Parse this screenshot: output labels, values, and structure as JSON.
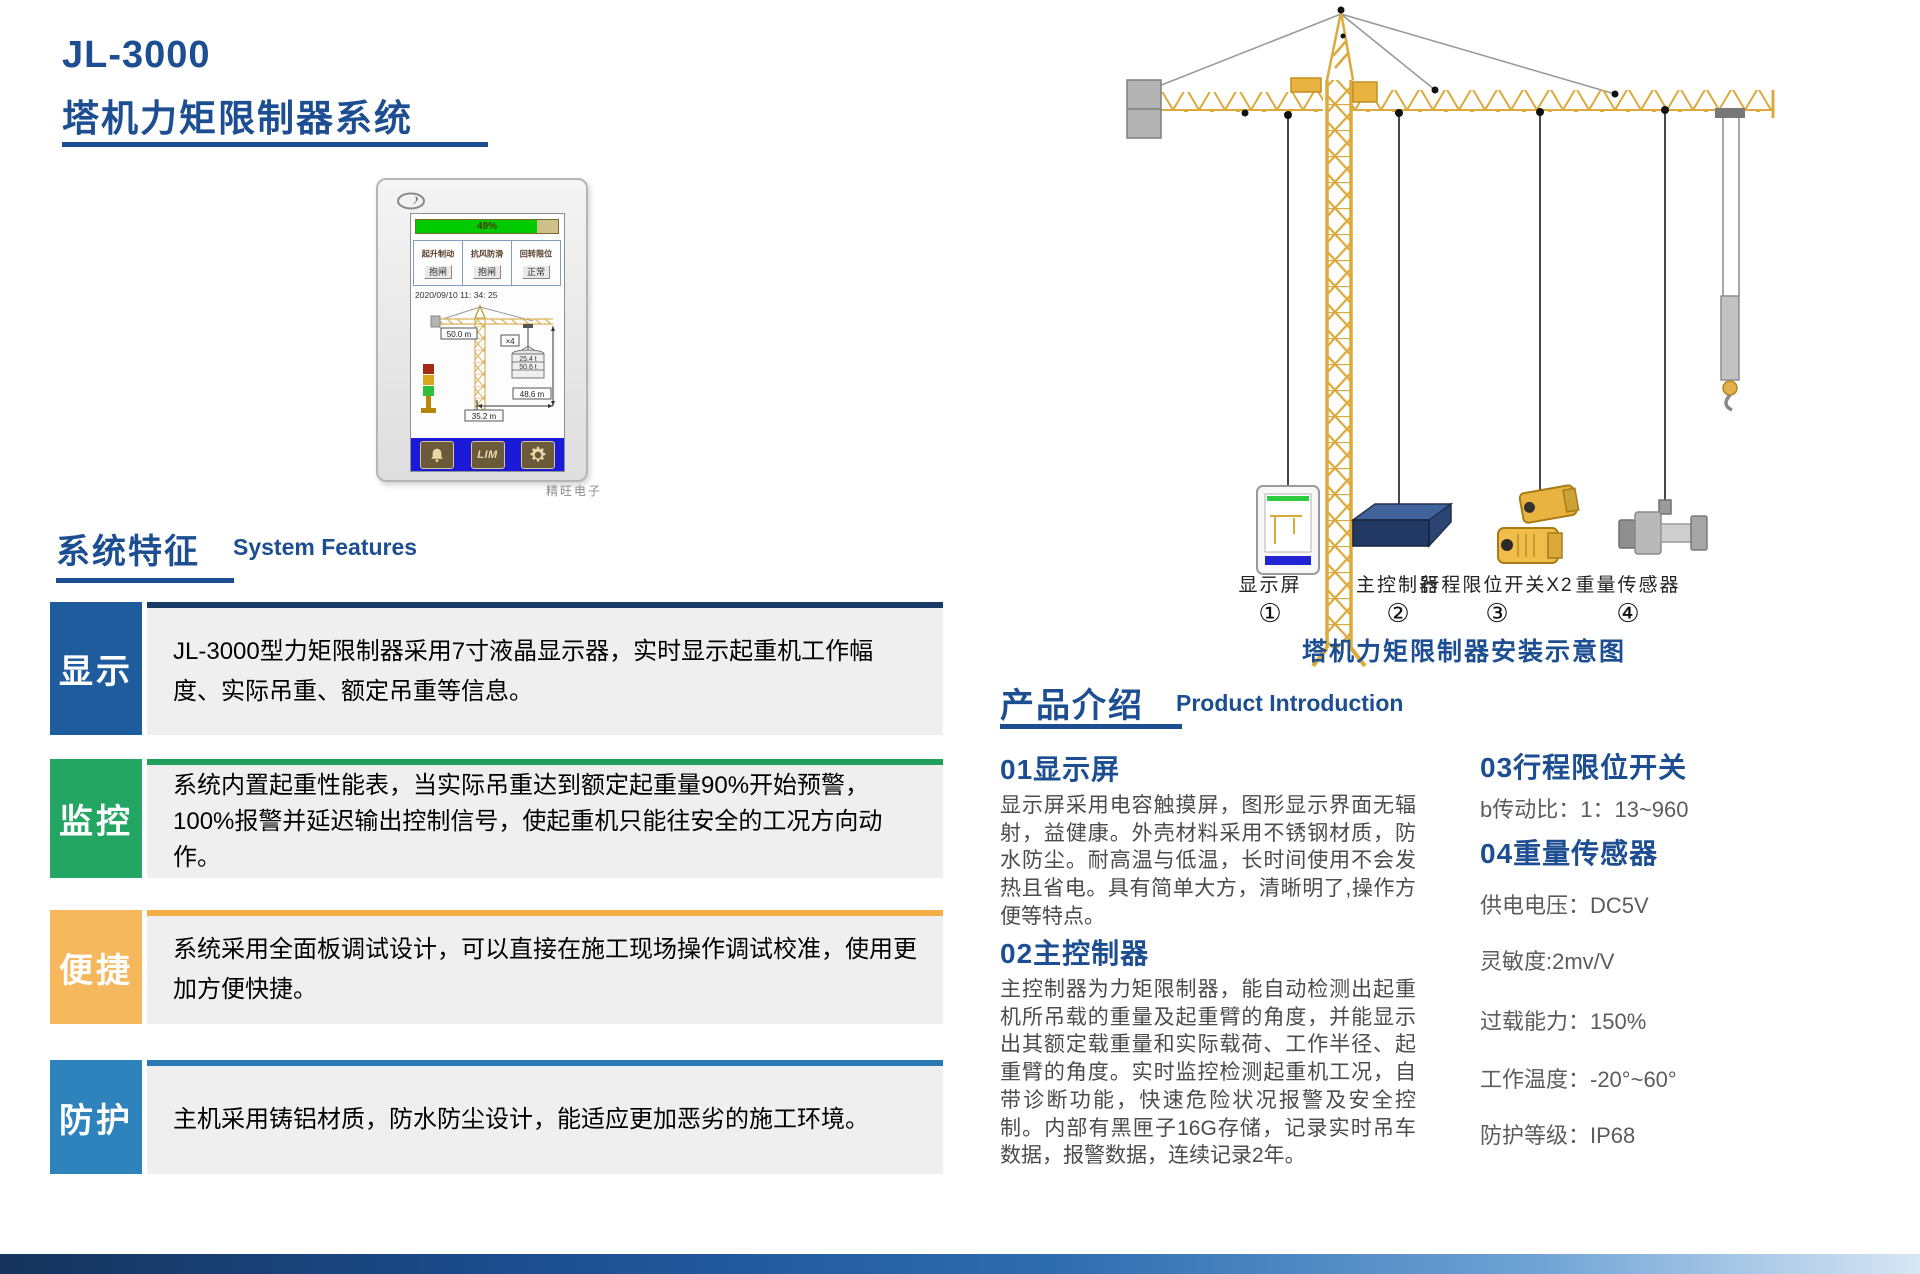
{
  "header": {
    "model": "JL-3000",
    "title": "塔机力矩限制器系统"
  },
  "device": {
    "brand": "精旺电子",
    "screen": {
      "progress": "49%",
      "columns": [
        {
          "label": "起升制动",
          "btn": "抱闸"
        },
        {
          "label": "抗风防滑",
          "btn": "抱闸"
        },
        {
          "label": "回转限位",
          "btn": "正常"
        }
      ],
      "datetime": "2020/09/10 11: 34: 25",
      "jib_length": "50.0 m",
      "ratio": "×4",
      "load_actual": "25.4 t",
      "load_rated": "50.6 t",
      "height": "48.6 m",
      "radius": "35.2 m",
      "lim": "LIM"
    }
  },
  "features": {
    "heading_cn": "系统特征",
    "heading_en": "System Features",
    "items": [
      {
        "tag": "显示",
        "color": "#1f5c9d",
        "text": "JL-3000型力矩限制器采用7寸液晶显示器，实时显示起重机工作幅度、实际吊重、额定吊重等信息。"
      },
      {
        "tag": "监控",
        "color": "#23a563",
        "text": "系统内置起重性能表，当实际吊重达到额定起重量90%开始预警，100%报警并延迟输出控制信号，使起重机只能往安全的工况方向动作。"
      },
      {
        "tag": "便捷",
        "color": "#f6b85c",
        "text": "系统采用全面板调试设计，可以直接在施工现场操作调试校准，使用更加方便快捷。"
      },
      {
        "tag": "防护",
        "color": "#2e83bd",
        "text": "主机采用铸铝材质，防水防尘设计，能适应更加恶劣的施工环境。"
      }
    ]
  },
  "crane": {
    "components": [
      {
        "label": "显示屏",
        "num": "①"
      },
      {
        "label": "主控制器",
        "num": "②"
      },
      {
        "label": "行程限位开关X2",
        "num": "③"
      },
      {
        "label": "重量传感器",
        "num": "④"
      }
    ],
    "caption": "塔机力矩限制器安装示意图"
  },
  "intro": {
    "heading_cn": "产品介绍",
    "heading_en": "Product Introduction",
    "s1": {
      "title": "01显示屏",
      "body": "显示屏采用电容触摸屏，图形显示界面无辐射，益健康。外壳材料采用不锈钢材质，防水防尘。耐高温与低温，长时间使用不会发热且省电。具有简单大方，清晰明了,操作方便等特点。"
    },
    "s2": {
      "title": "02主控制器",
      "body": "主控制器为力矩限制器，能自动检测出起重机所吊载的重量及起重臂的角度，并能显示出其额定载重量和实际载荷、工作半径、起重臂的角度。实时监控检测起重机工况，自带诊断功能，快速危险状况报警及安全控制。内部有黑匣子16G存储，记录实时吊车数据，报警数据，连续记录2年。"
    },
    "s3": {
      "title": "03行程限位开关",
      "spec1": "b传动比：1：13~960"
    },
    "s4": {
      "title": "04重量传感器",
      "specs": [
        "供电电压：DC5V",
        "灵敏度:2mv/V",
        "过载能力：150%",
        "工作温度：-20°~60°",
        "防护等级：IP68"
      ]
    }
  },
  "colors": {
    "primary": "#1c4e91",
    "feature_blue": "#1f5c9d",
    "feature_green": "#23a563",
    "feature_yellow": "#f6b85c",
    "feature_steel": "#2e83bd",
    "crane_yellow": "#e2a93b"
  }
}
